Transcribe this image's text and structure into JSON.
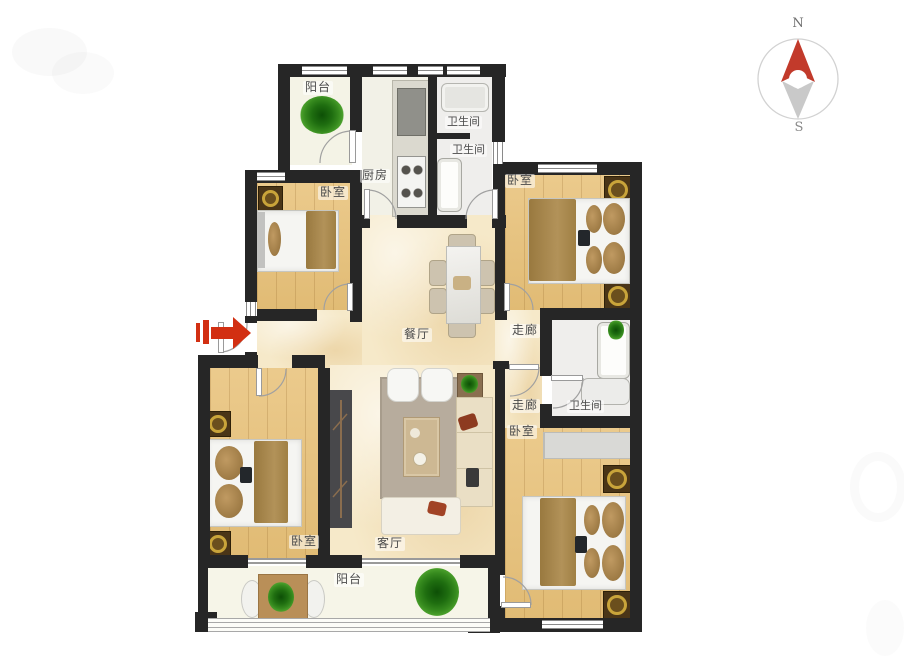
{
  "compass": {
    "north_label": "N",
    "south_label": "S"
  },
  "rooms": {
    "balcony_top": {
      "label": "阳台"
    },
    "kitchen": {
      "label": "厨房"
    },
    "bath_top": {
      "label": "卫生间"
    },
    "bath_mid": {
      "label": "卫生间"
    },
    "bedroom_nw": {
      "label": "卧室"
    },
    "bedroom_ne": {
      "label": "卧室"
    },
    "dining": {
      "label": "餐厅"
    },
    "corridor_upper": {
      "label": "走廊"
    },
    "corridor_lower": {
      "label": "走廊"
    },
    "bath_right": {
      "label": "卫生间"
    },
    "bedroom_se": {
      "label": "卧室"
    },
    "bedroom_sw": {
      "label": "卧室"
    },
    "living": {
      "label": "客厅"
    },
    "balcony_bottom": {
      "label": "阳台"
    }
  },
  "colors": {
    "wall": "#262626",
    "wood_floor": "#e8c178",
    "tile_floor": "#f6e9c9",
    "utility_floor": "#f2f1e7",
    "accent_red": "#d22f12",
    "compass_red": "#c23a2b",
    "gold": "#c9a43a",
    "blanket_tan": "#a5854f",
    "rug_gray": "#b7ac9d",
    "tv_unit_gray": "#48484b",
    "sofa_cream": "#eadfc5",
    "plant_green": "#2e7d1d"
  }
}
